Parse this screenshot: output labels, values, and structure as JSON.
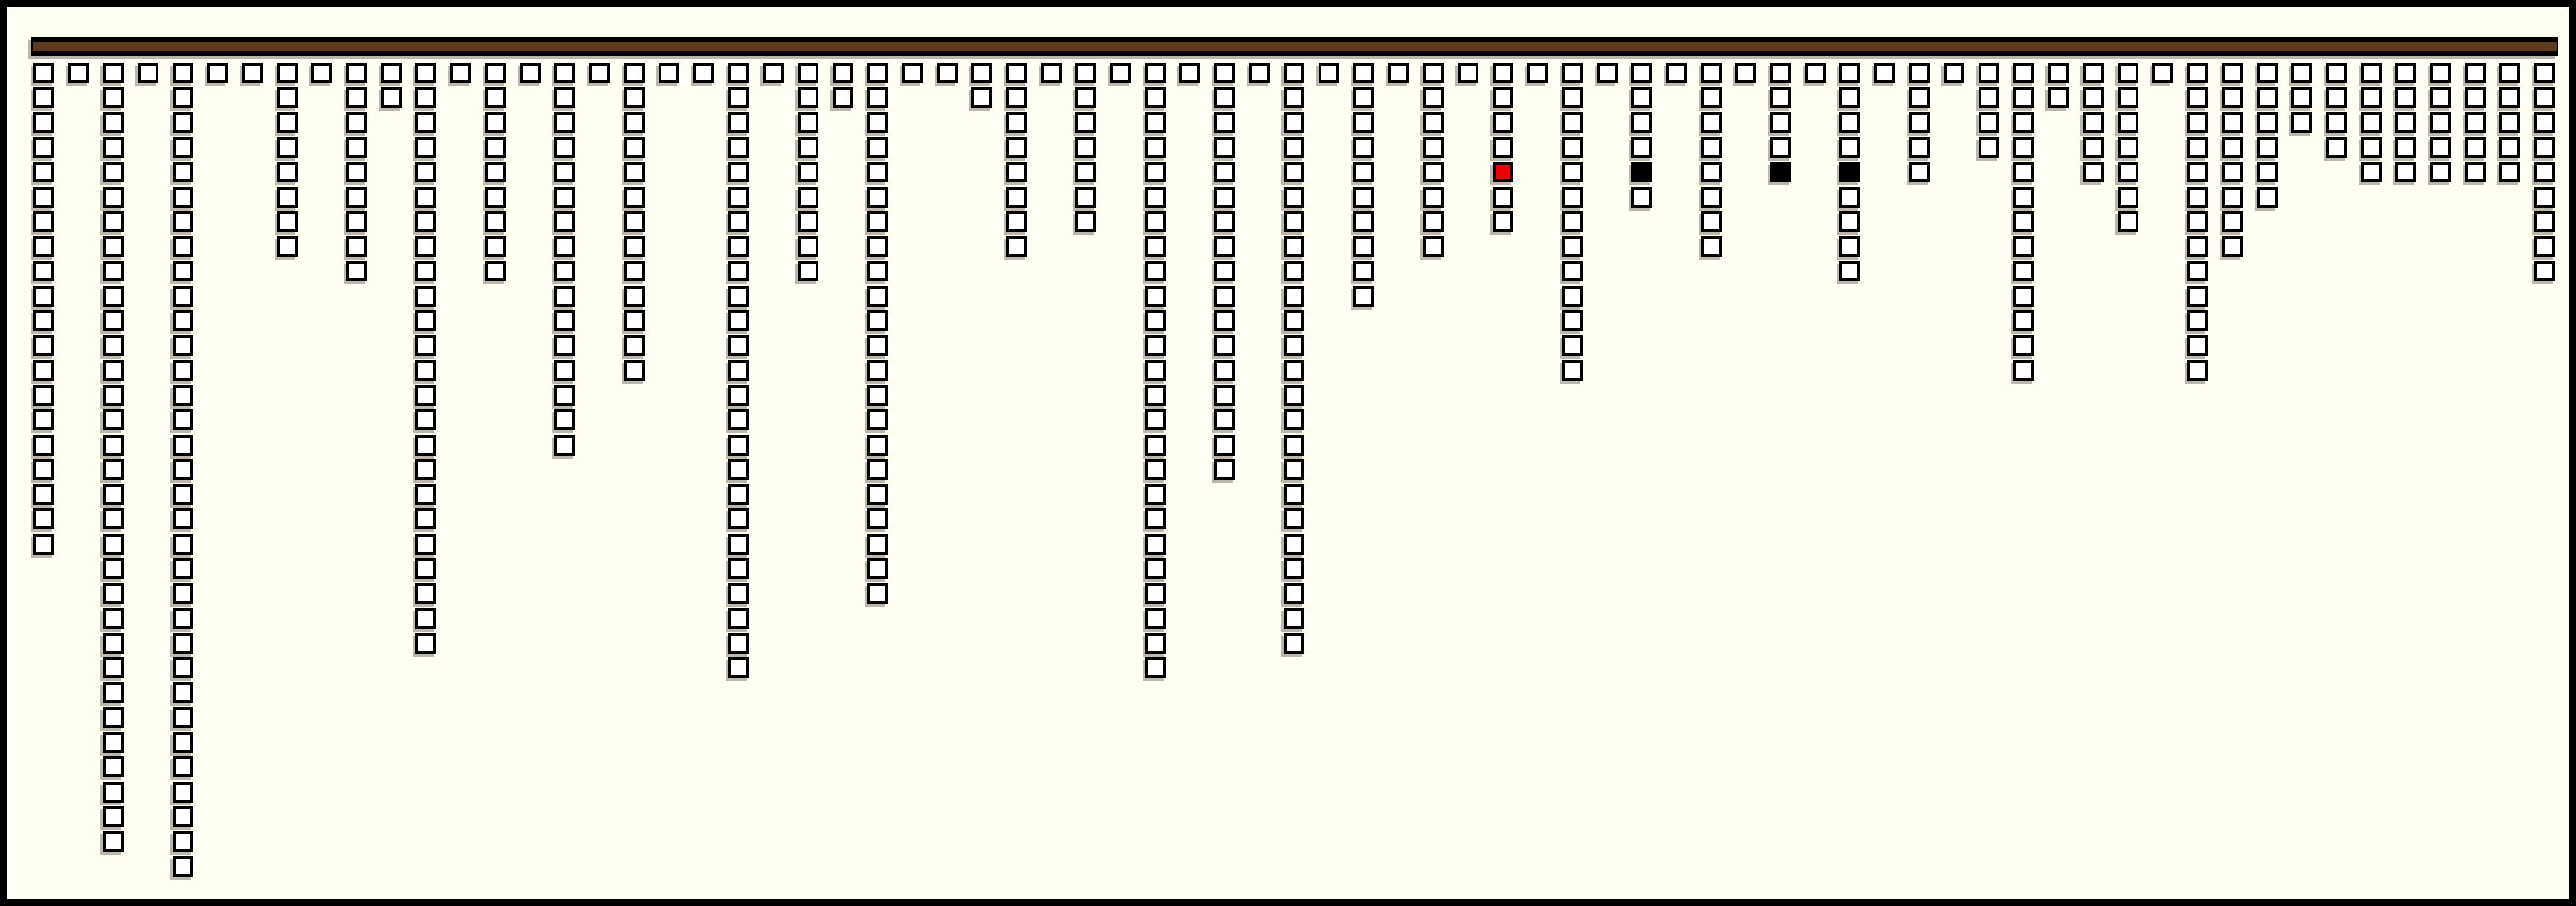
{
  "canvas": {
    "background_color": "#fffef2",
    "frame_color": "#000000"
  },
  "header_bar": {
    "fill_color": "#5e3a1f",
    "border_color": "#000000"
  },
  "chart_data": {
    "type": "bar",
    "subtype": "unit-square-waffle-columns",
    "title": "",
    "xlabel": "",
    "ylabel": "",
    "description": "73 columns of outlined unit squares hang downward from a horizontal brown bar; each column's value equals its number of squares. Four cells in row 5 are filled: one red, three black.",
    "orientation": "top-down",
    "num_columns": 73,
    "max_value": 33,
    "values": [
      20,
      1,
      32,
      1,
      33,
      1,
      1,
      8,
      1,
      9,
      2,
      24,
      1,
      9,
      1,
      16,
      1,
      13,
      1,
      1,
      25,
      1,
      9,
      2,
      22,
      1,
      1,
      2,
      8,
      1,
      7,
      1,
      25,
      1,
      17,
      1,
      24,
      1,
      10,
      1,
      8,
      1,
      7,
      1,
      13,
      1,
      6,
      1,
      8,
      1,
      5,
      1,
      9,
      1,
      5,
      1,
      4,
      13,
      2,
      5,
      7,
      1,
      13,
      8,
      6,
      3,
      4,
      5,
      5,
      5,
      5,
      5,
      9
    ],
    "square_fill": "#ffffff",
    "square_border": "#000000",
    "shadow_color": "rgba(105,98,86,0.45)",
    "highlighted_cells": [
      {
        "column": 43,
        "row": 5,
        "fill": "#ee0000",
        "label": "red-cell"
      },
      {
        "column": 47,
        "row": 5,
        "fill": "#000000",
        "label": "black-cell"
      },
      {
        "column": 51,
        "row": 5,
        "fill": "#000000",
        "label": "black-cell"
      },
      {
        "column": 53,
        "row": 5,
        "fill": "#000000",
        "label": "black-cell"
      }
    ],
    "legend": [],
    "grid_lines": "off"
  }
}
